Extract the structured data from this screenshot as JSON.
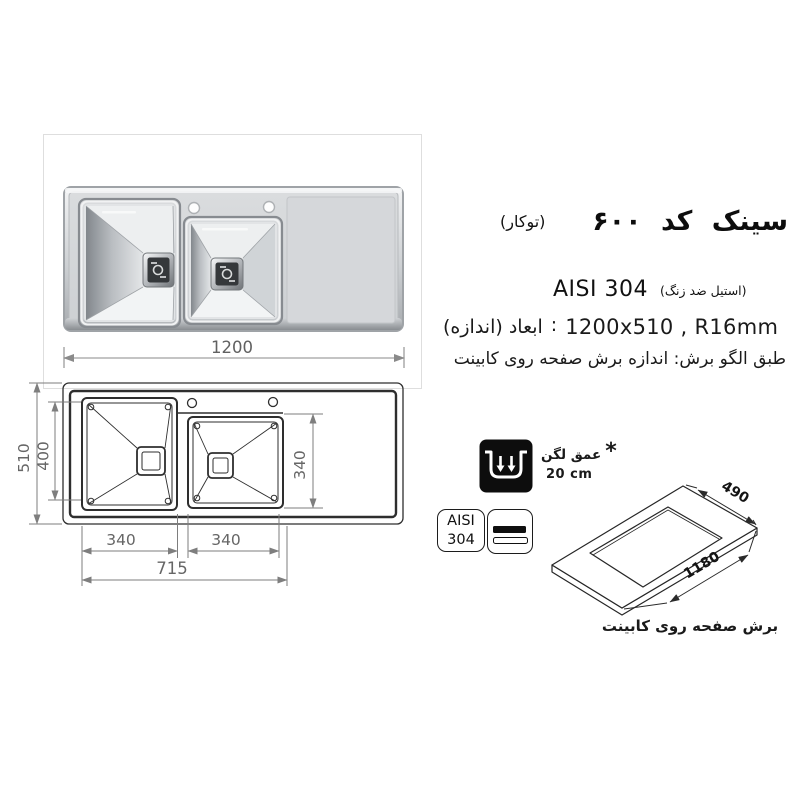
{
  "header": {
    "title": "سینک کد ۶۰۰",
    "mount_type": "(توکار)"
  },
  "specs": {
    "material": "AISI 304",
    "material_note": "(استیل ضد زنگ)",
    "dims_label": "ابعاد (اندازه)",
    "dims_sep": ":",
    "dims_value": "1200x510 , R16mm",
    "cutting_note": "طبق الگو برش: اندازه برش صفحه روی کابینت"
  },
  "photo": {
    "width_dim": "1200"
  },
  "top_view": {
    "outer_height": "510",
    "bowl_inner_height": "400",
    "bowl2_inner_height": "340",
    "bowl1_width": "340",
    "bowl2_width": "340",
    "bowls_span": "715"
  },
  "depth_note": {
    "asterisk": "*",
    "label": "عمق لگن",
    "value": "20 cm"
  },
  "material_badge": {
    "line1": "AISI",
    "line2": "304"
  },
  "cutout_view": {
    "depth": "490",
    "width": "1180",
    "caption": "برش صفحه روی کابینت"
  },
  "colors": {
    "dim_gray": "#7e7e7e",
    "drawing_line": "#2e2e2e",
    "steel_light": "#eef0f1",
    "steel_dark": "#878c91"
  }
}
